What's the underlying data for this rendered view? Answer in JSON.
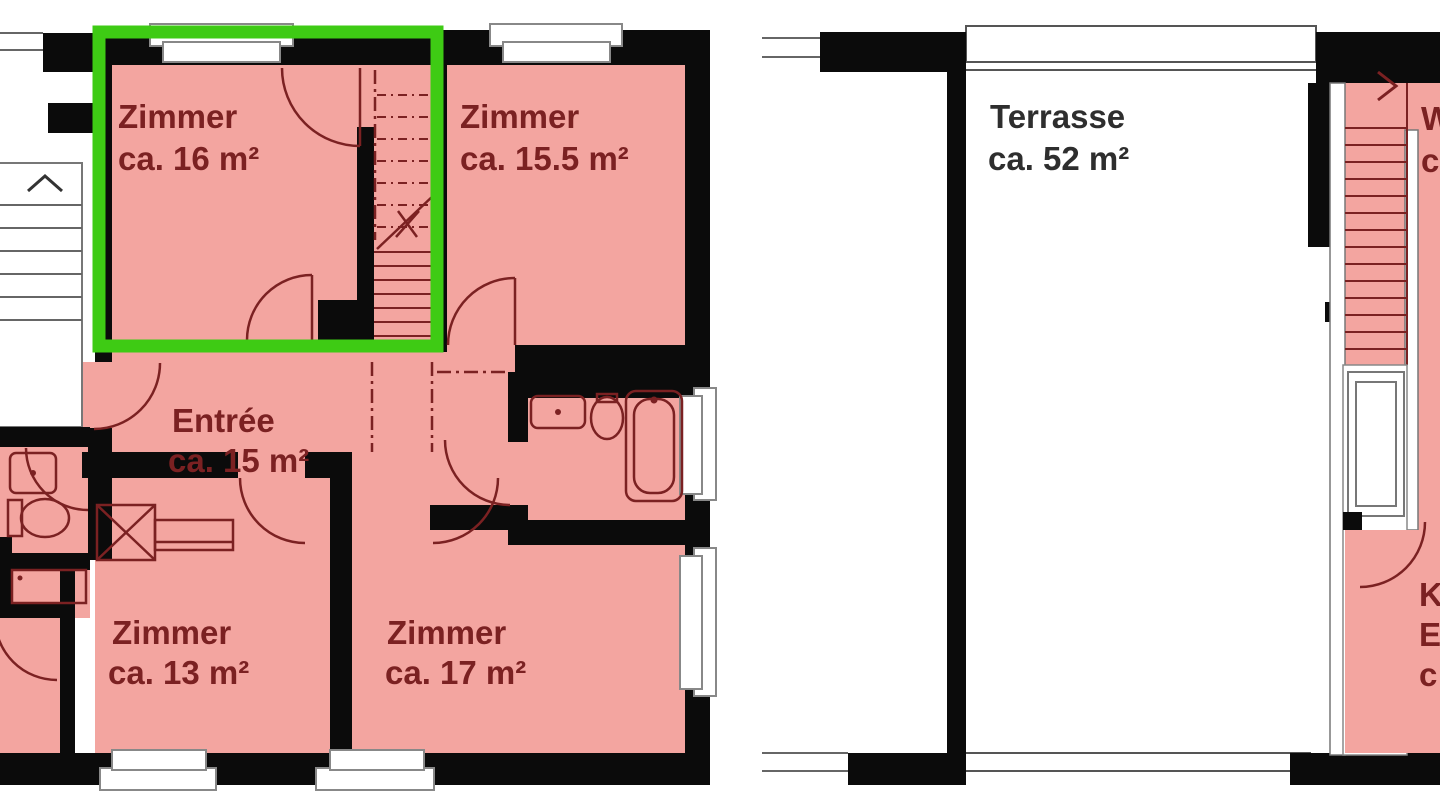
{
  "document": {
    "type": "apartment-floor-plan",
    "background": "#ffffff"
  },
  "colors": {
    "room_fill": "#f3a5a0",
    "wall": "#0b0b0b",
    "linework": "#7b2122",
    "highlight_green": "#3ecb14",
    "terrace_lines": "#666666",
    "window_border": "#888888",
    "terrace_text": "#2e2e2e"
  },
  "left_plan": {
    "name": "main-floor",
    "rooms": [
      {
        "id": "zimmer16",
        "label": "Zimmer",
        "area": "ca. 16 m²",
        "highlighted": true
      },
      {
        "id": "zimmer155",
        "label": "Zimmer",
        "area": "ca. 15.5 m²",
        "highlighted": false
      },
      {
        "id": "entree",
        "label": "Entrée",
        "area": "ca. 15 m²",
        "highlighted": false
      },
      {
        "id": "zimmer13",
        "label": "Zimmer",
        "area": "ca. 13 m²",
        "highlighted": false
      },
      {
        "id": "zimmer17",
        "label": "Zimmer",
        "area": "ca. 17 m²",
        "highlighted": false
      }
    ]
  },
  "right_plan": {
    "name": "upper-floor-terrace",
    "rooms": [
      {
        "id": "terrasse",
        "label": "Terrasse",
        "area": "ca. 52 m²"
      }
    ],
    "partial_labels": {
      "top_w": "W",
      "top_c": "c",
      "bottom_k": "K",
      "bottom_e": "E",
      "bottom_c": "c"
    }
  },
  "highlight": {
    "room": "zimmer16",
    "color": "#3ecb14"
  }
}
